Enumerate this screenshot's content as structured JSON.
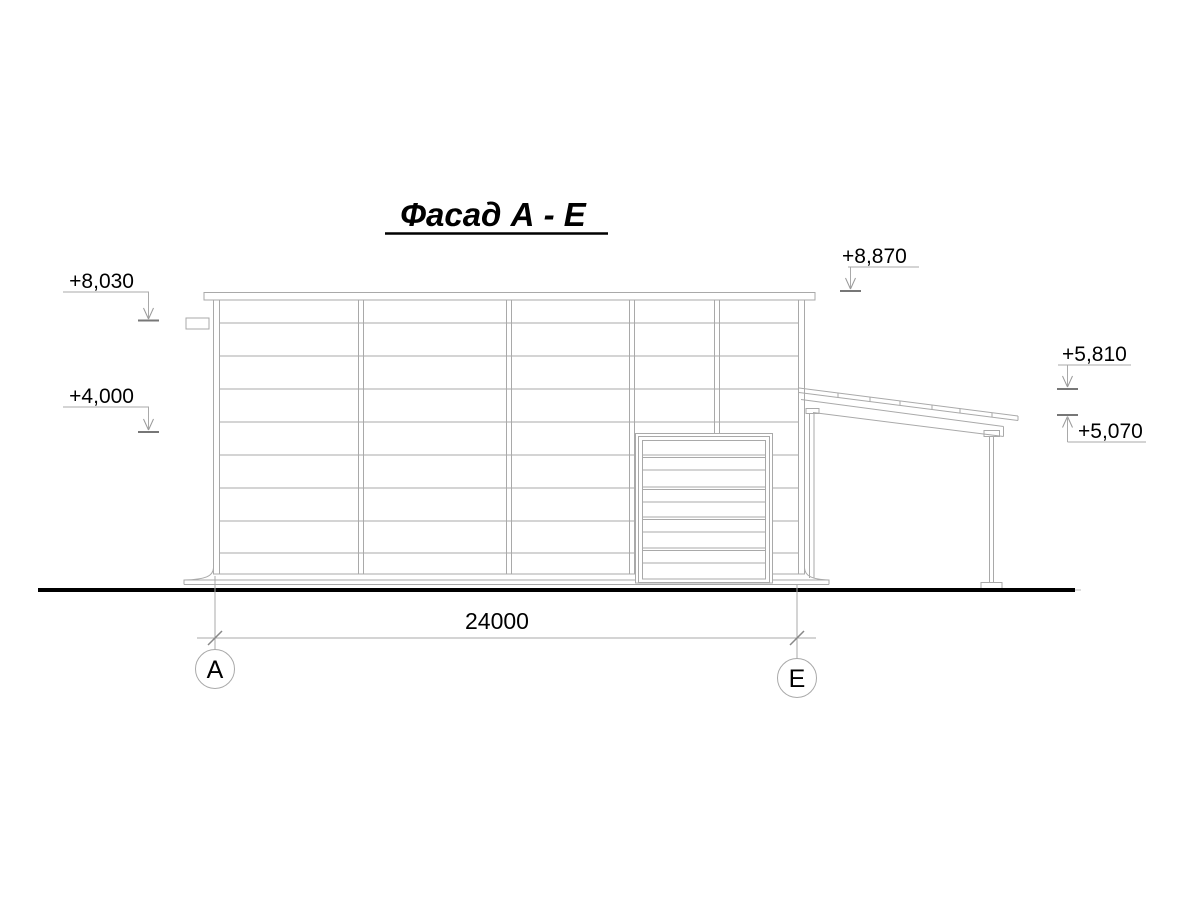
{
  "title": {
    "text": "Фасад А - Е"
  },
  "elevation_marks": [
    {
      "id": "parapet-left",
      "label": "+8,030"
    },
    {
      "id": "mid-left",
      "label": "+4,000"
    },
    {
      "id": "parapet-right",
      "label": "+8,870"
    },
    {
      "id": "annex-roof-high",
      "label": "+5,810"
    },
    {
      "id": "annex-roof-low",
      "label": "+5,070"
    }
  ],
  "dimension": {
    "label": "24000"
  },
  "axes": [
    {
      "label": "А"
    },
    {
      "label": "Е"
    }
  ],
  "colors": {
    "line": "#a9a9a9",
    "dark_line": "#777777",
    "ground": "#000000",
    "text": "#000000"
  }
}
